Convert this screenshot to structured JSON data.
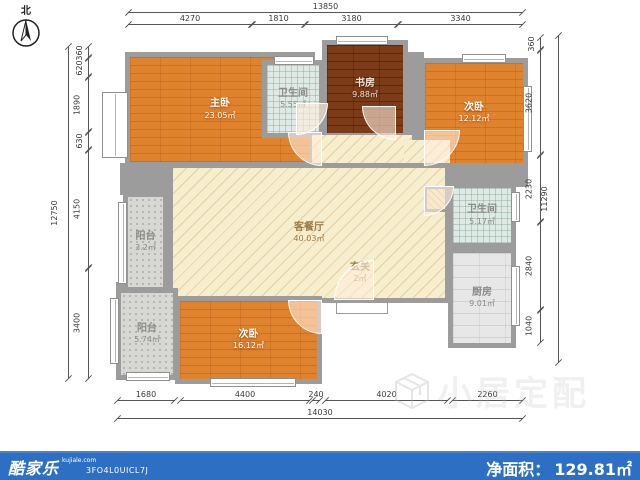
{
  "north": {
    "label": "北"
  },
  "rooms": [
    {
      "name": "主卧",
      "area": "23.05㎡"
    },
    {
      "name": "卫生间",
      "area": "5.55㎡"
    },
    {
      "name": "书房",
      "area": "9.88㎡"
    },
    {
      "name": "次卧",
      "area": "12.12㎡"
    },
    {
      "name": "卫生间",
      "area": "5.17㎡"
    },
    {
      "name": "厨房",
      "area": "9.01㎡"
    },
    {
      "name": "客餐厅",
      "area": "40.03㎡"
    },
    {
      "name": "玄关",
      "area": "2㎡"
    },
    {
      "name": "阳台",
      "area": "3.2㎡"
    },
    {
      "name": "阳台",
      "area": "5.74㎡"
    },
    {
      "name": "次卧",
      "area": "16.12㎡"
    }
  ],
  "dims": {
    "top": {
      "total": "13850",
      "segments": [
        "4270",
        "1810",
        "3180",
        "3340"
      ]
    },
    "bottom": {
      "total": "14030",
      "segments": [
        "1680",
        "4400",
        "240",
        "4020",
        "2260"
      ]
    },
    "left": {
      "total": "12750",
      "segments": [
        "360",
        "620",
        "1890",
        "630",
        "4150",
        "3400"
      ]
    },
    "right": {
      "total": "11290",
      "segments": [
        "360",
        "3620",
        "2230",
        "2840",
        "1040"
      ]
    }
  },
  "watermark": {
    "text": "小居定配"
  },
  "footer": {
    "brand": "酷家乐",
    "brand_site": "kujiale.com",
    "plan_code": "3FO4L0UICL7J",
    "net_area_label": "净面积：",
    "net_area_value": "129.81㎡",
    "bar_color": "#2d6fc2"
  }
}
